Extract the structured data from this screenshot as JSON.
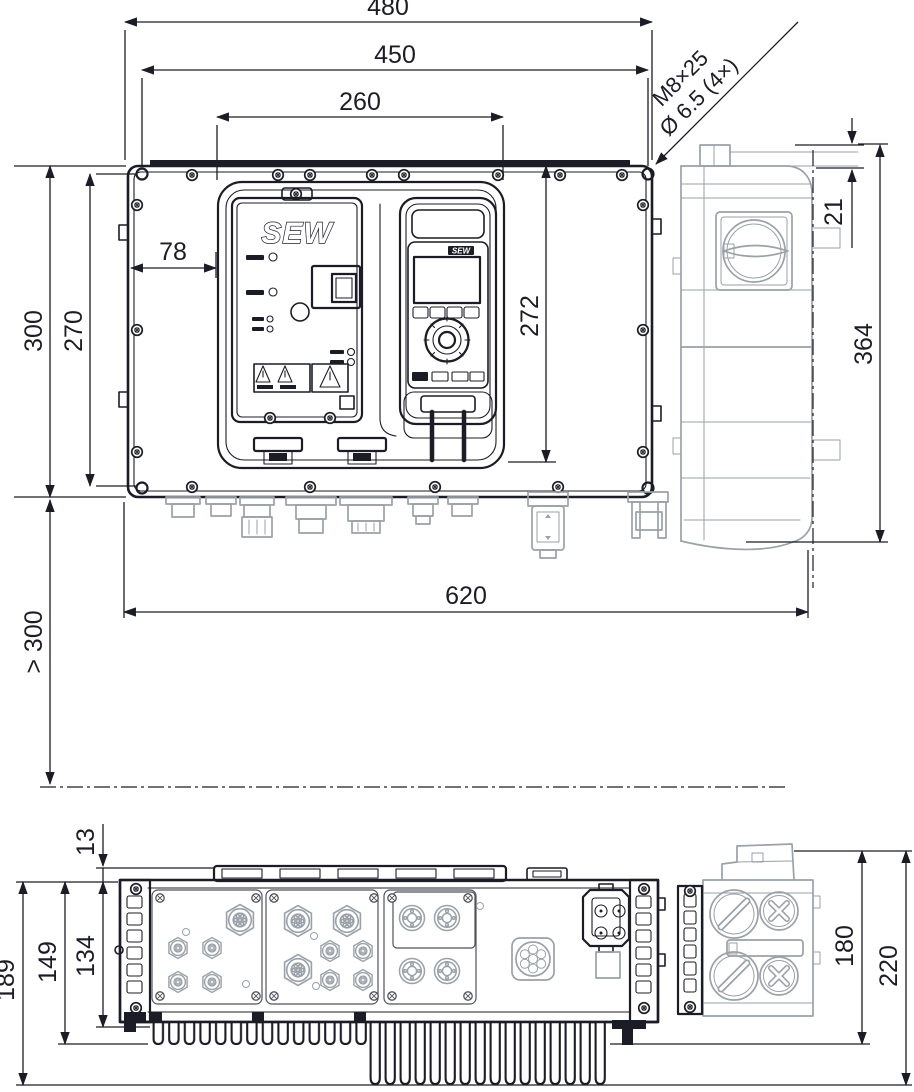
{
  "drawing": {
    "branding": {
      "logo": "SEW",
      "keypad_logo": "SEW"
    },
    "colors": {
      "line": "#1c1c26",
      "secondary": "#9aa1a8",
      "background": "#ffffff"
    },
    "views": {
      "front": "front-view",
      "side": "side-view",
      "bottom": "bottom-view"
    },
    "dimensions_mm": {
      "overall_width": "480",
      "mounting_hole_spacing_x": "450",
      "cover_width": "260",
      "overall_height": "300",
      "mounting_hole_spacing_y": "270",
      "cover_offset_x": "78",
      "cover_height": "272",
      "total_width_with_side": "620",
      "min_clearance_below": "> 300",
      "side_rail_offset": "21",
      "side_height": "364",
      "rail_height": "13",
      "depth_body": "134",
      "depth_with_short_fins": "149",
      "depth_overall": "189",
      "side_module_depth": "180",
      "side_overall_depth": "220"
    },
    "notes": {
      "mounting_bolt": "M8×25",
      "mounting_hole": "Ø 6.5 (4×)"
    }
  }
}
